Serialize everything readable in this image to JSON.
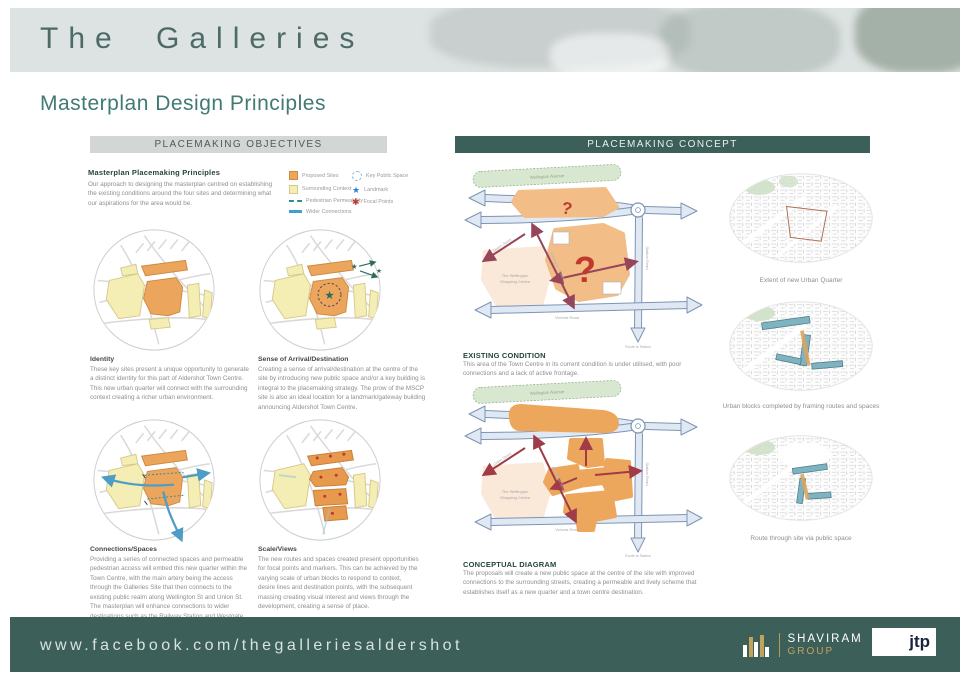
{
  "header": {
    "title": "The Galleries",
    "subtitle": "Masterplan Design Principles"
  },
  "bars": {
    "objectives": "PLACEMAKING OBJECTIVES",
    "concept": "PLACEMAKING CONCEPT"
  },
  "objectives": {
    "intro_heading": "Masterplan Placemaking Principles",
    "intro_body": "Our approach to designing the masterplan centred on establishing the existing conditions around the four sites and determining what our aspirations for the area would be.",
    "legend": [
      {
        "label": "Proposed Sites"
      },
      {
        "label": "Surrounding Context"
      },
      {
        "label": "Pedestrian Permeability"
      },
      {
        "label": "Wider Connections"
      },
      {
        "label": "Key Public Space"
      },
      {
        "label": "Landmark"
      },
      {
        "label": "Focal Points"
      }
    ],
    "principles": [
      {
        "heading": "Identity",
        "body": "These key sites present a unique opportunity to generate a distinct identity for this part of Aldershot Town Centre. This new urban quarter will connect with the surrounding context creating a richer urban environment."
      },
      {
        "heading": "Sense of Arrival/Destination",
        "body": "Creating a sense of arrival/destination at the centre of the site by introducing new public space and/or a key building is integral to the placemaking strategy. The prow of the MSCP site is also an ideal location for a landmark/gateway building announcing Aldershot Town Centre."
      },
      {
        "heading": "Connections/Spaces",
        "body": "Providing a series of connected spaces and permeable pedestrian access will embed this new quarter within the Town Centre, with the main artery being the access through the Galleries Site that then connects to the existing public realm along Wellington St and Union St. The masterplan will enhance connections to wider destinations such as the Railway Station and Westgate Shopping Centre."
      },
      {
        "heading": "Scale/Views",
        "body": "The new routes and spaces created present opportunities for focal points and markers. This can be achieved by the varying scale of urban blocks to respond to context, desire lines and destination points, with the subsequent massing creating visual interest and views through the development, creating a sense of place."
      }
    ]
  },
  "concept": {
    "existing_heading": "EXISTING CONDITION",
    "existing_body": "This area of the Town Centre in its current condition is under utilised, with poor connections and a lack of active frontage.",
    "conceptual_heading": "CONCEPTUAL DIAGRAM",
    "conceptual_body": "The proposals will create a new public space at the centre of the site with improved connections to the surrounding streets, creating a permeable and lively scheme that establishes itself as a new quarter and a town centre destination.",
    "labels": {
      "wellington_avenue": "Wellington Avenue",
      "union_street": "Union Street",
      "wellington_street": "Wellington Street",
      "shopping_centre_line1": "The Wellington",
      "shopping_centre_line2": "Shopping Centre",
      "victoria_road": "Victoria Road",
      "station_road": "Station Road",
      "route_to_station": "Route to Station",
      "question_mark": "?"
    }
  },
  "studies": [
    {
      "caption": "Extent of new Urban Quarter"
    },
    {
      "caption": "Urban blocks completed by framing routes and spaces"
    },
    {
      "caption": "Route through site via public space"
    }
  ],
  "footer": {
    "url": "www.facebook.com/thegalleriesaldershot",
    "shaviram_name": "SHAVIRAM",
    "shaviram_sub": "GROUP",
    "jtp": "jtp"
  },
  "colors": {
    "brand_teal": "#3c5f59",
    "heading_teal": "#417a73",
    "proposed_orange": "#eda75c",
    "context_yellow": "#f5eeb4",
    "focal_red": "#c0392f",
    "landmark_blue": "#2f7fd0",
    "road_blue": "#7d95b5"
  }
}
